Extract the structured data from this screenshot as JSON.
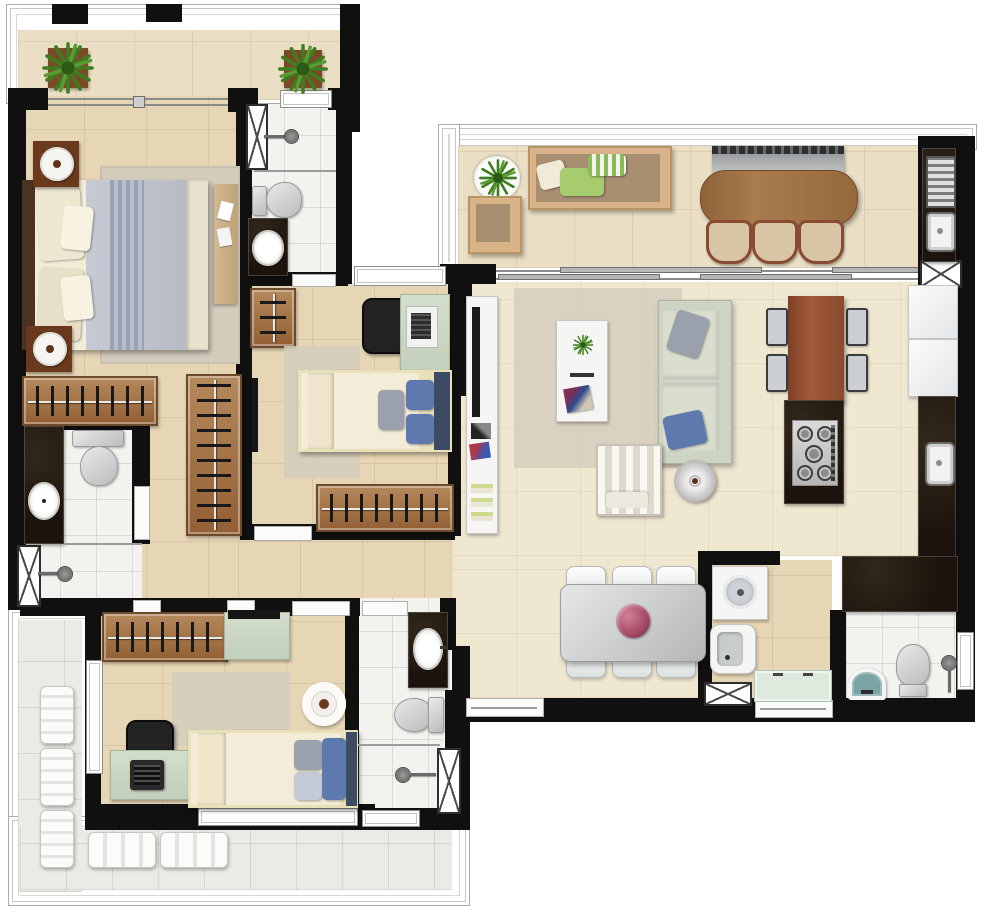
{
  "meta": {
    "kind": "apartment-floor-plan",
    "width_px": 1000,
    "height_px": 907,
    "visible_text": "none"
  },
  "palette": {
    "wall": "#101010",
    "floor_tan": "#e7d6b5",
    "floor_cream": "#f0e7d1",
    "floor_balcony": "#eadec5",
    "floor_white_tile": "#f3f2ee",
    "floor_grey_tile": "#ebeae5",
    "granite_dark": "#1e150d",
    "wood_dark": "#5f3519",
    "wood_mid": "#9a6c44",
    "wood_bar": "#a87c4f",
    "wood_table_red": "#8d4b31",
    "sage_furniture": "#ccd7c5",
    "sage_light": "#dfeade",
    "sofa_sage": "#cdd4c4",
    "outdoor_sofa_tan": "#d8b488",
    "pillow_blue": "#5e79ad",
    "pillow_navy": "#3c4a63",
    "pillow_grey": "#9aa0ac",
    "pillow_green": "#a6cc6e",
    "rug_grey": "#d5ccbd",
    "plant_green": "#3e7d20",
    "chair_white": "#f1f3f3",
    "steel_silver": "#c9cbcd",
    "teal_sink": "#7aa3a3",
    "flower_pink": "#b05570",
    "duvet_grey": "#bcc0ca",
    "mattress_cream": "#f3ecd9"
  },
  "rooms": [
    {
      "id": "balcony-top-left",
      "items": [
        "potted-plant",
        "potted-plant",
        "sliding-door"
      ]
    },
    {
      "id": "master-bedroom",
      "items": [
        "double-bed",
        "nightstand-with-lamp",
        "nightstand-with-lamp",
        "area-rug",
        "dresser"
      ]
    },
    {
      "id": "master-closet",
      "items": [
        "wardrobe-rack",
        "wardrobe-rack"
      ]
    },
    {
      "id": "master-bathroom",
      "items": [
        "granite-vanity-sink",
        "toilet",
        "shower",
        "utility-shaft"
      ]
    },
    {
      "id": "bathroom-2",
      "items": [
        "shower",
        "toilet",
        "granite-vanity-sink",
        "utility-shaft"
      ]
    },
    {
      "id": "bedroom-2",
      "items": [
        "single-bed",
        "desk",
        "office-chair",
        "laptop",
        "wardrobe-rack",
        "closet-rack",
        "area-rug",
        "wall-tv"
      ]
    },
    {
      "id": "hallway",
      "items": []
    },
    {
      "id": "bedroom-3",
      "items": [
        "single-bed",
        "desk",
        "office-chair",
        "laptop",
        "wardrobe-rack",
        "sideboard-tv",
        "round-table",
        "area-rug"
      ]
    },
    {
      "id": "bathroom-3",
      "items": [
        "granite-vanity-sink",
        "toilet",
        "shower",
        "utility-shaft"
      ]
    },
    {
      "id": "balcony-left",
      "items": [
        "lounge-chair",
        "lounge-chair",
        "lounge-chair"
      ]
    },
    {
      "id": "balcony-bottom",
      "items": [
        "bench-seat",
        "bench-seat"
      ]
    },
    {
      "id": "gourmet-balcony",
      "items": [
        "barbecue-grill",
        "bar-table",
        "stool",
        "stool",
        "stool",
        "outdoor-sofa",
        "outdoor-armchair",
        "plant-tray",
        "grill-counter",
        "counter-sink",
        "utility-shaft"
      ]
    },
    {
      "id": "living-room",
      "items": [
        "tv-console",
        "tv",
        "area-rug",
        "coffee-table",
        "sofa",
        "striped-armchair",
        "round-side-table"
      ]
    },
    {
      "id": "kitchen",
      "items": [
        "kitchen-table",
        "chair",
        "chair",
        "chair",
        "chair",
        "island-cooktop",
        "appliance",
        "appliance",
        "counter-sink"
      ]
    },
    {
      "id": "dining-room",
      "items": [
        "dining-table",
        "dining-chair",
        "dining-chair",
        "dining-chair",
        "dining-chair",
        "dining-chair",
        "dining-chair",
        "flower-centerpiece"
      ]
    },
    {
      "id": "laundry",
      "items": [
        "washing-machine",
        "laundry-sink",
        "cabinet-run",
        "utility-shaft"
      ]
    },
    {
      "id": "service-bathroom",
      "items": [
        "wash-basin",
        "toilet",
        "shower",
        "window"
      ]
    }
  ],
  "openings": [
    "balcony-sliding-door-master",
    "balcony-sliding-door-living",
    "main-entry-door",
    "service-entry-door",
    "bedroom-2-door",
    "bedroom-3-door",
    "bathroom-doors",
    "windows"
  ]
}
